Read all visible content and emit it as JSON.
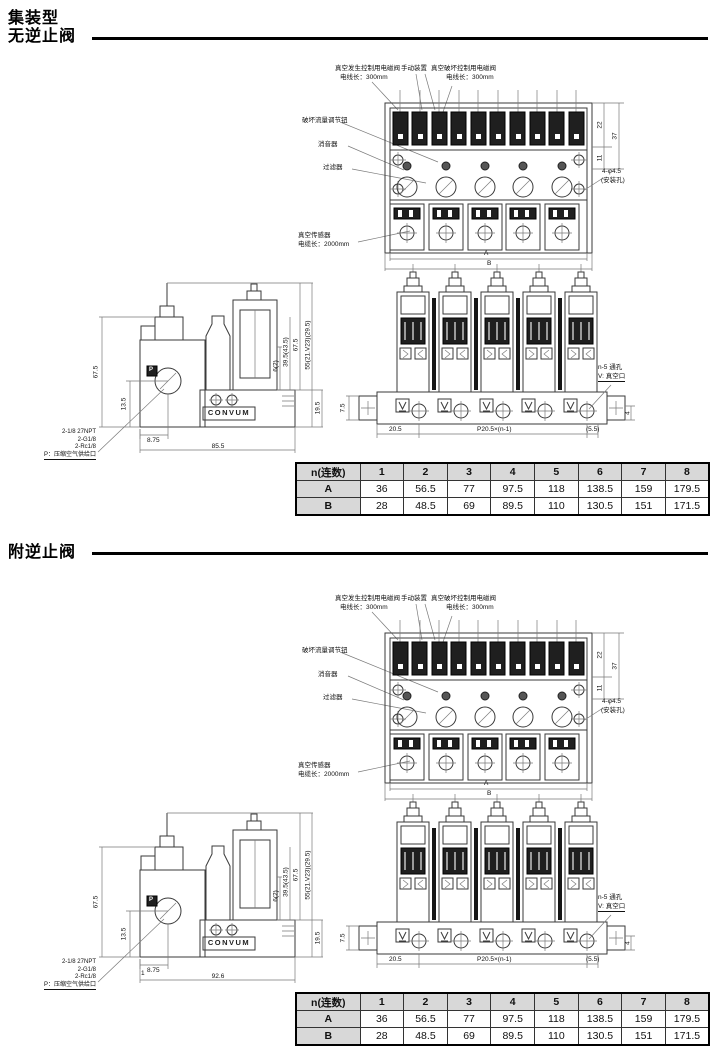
{
  "titles": {
    "group": "集装型",
    "section1": "无逆止阀",
    "section2": "附逆止阀"
  },
  "shared": {
    "front": {
      "solenoid_gen": "真空发生控制用电磁阀",
      "solenoid_gen_wire": "电线长：300mm",
      "manual": "手动装置",
      "solenoid_break": "真空破坏控制用电磁阀",
      "solenoid_break_wire": "电线长：300mm",
      "flow_knob": "破坏流量调节钮",
      "silencer": "消音器",
      "filter": "过滤器",
      "sensor": "真空传感器",
      "sensor_wire": "电缆长：2000mm",
      "dim_a": "A",
      "dim_b": "B",
      "dim22": "22",
      "dim37": "37",
      "dim11": "11",
      "mount_hole": "4-φ4.5",
      "mount_hole_note": "(安装孔)"
    },
    "bottom": {
      "through": "n-5 通孔",
      "vport": "V: 真空口",
      "dim_left": "20.5",
      "dim_pitch": "P20.5×(n-1)",
      "dim_right": "(5.5)",
      "dim_h": "7.5",
      "dim_v": "4"
    },
    "side": {
      "h": "67.5",
      "h_port": "13.5",
      "w_port": "8.75",
      "r1": "6(2)",
      "r2": "39.5(43.5)",
      "r3": "67.5",
      "r4": "55(21.V23)(29.5)",
      "r5": "19.5",
      "port_letter": "P",
      "logo": "CONVUM",
      "port1": "2-1/8 27NPT",
      "port2": "2-G1/8",
      "port3": "2-Rc1/8",
      "port4": "P：压缩空气供给口"
    }
  },
  "section1": {
    "side_width": "85.5",
    "table": {
      "header": [
        "n(连数)",
        "1",
        "2",
        "3",
        "4",
        "5",
        "6",
        "7",
        "8"
      ],
      "row_a": [
        "A",
        "36",
        "56.5",
        "77",
        "97.5",
        "118",
        "138.5",
        "159",
        "179.5"
      ],
      "row_b": [
        "B",
        "28",
        "48.5",
        "69",
        "89.5",
        "110",
        "130.5",
        "151",
        "171.5"
      ]
    }
  },
  "section2": {
    "side_width": "92.6",
    "extra_dim": "1",
    "table": {
      "header": [
        "n(连数)",
        "1",
        "2",
        "3",
        "4",
        "5",
        "6",
        "7",
        "8"
      ],
      "row_a": [
        "A",
        "36",
        "56.5",
        "77",
        "97.5",
        "118",
        "138.5",
        "159",
        "179.5"
      ],
      "row_b": [
        "B",
        "28",
        "48.5",
        "69",
        "89.5",
        "110",
        "130.5",
        "151",
        "171.5"
      ]
    }
  },
  "chart_data": {
    "type": "table",
    "title": "集装型尺寸表 A/B",
    "categories": [
      "1",
      "2",
      "3",
      "4",
      "5",
      "6",
      "7",
      "8"
    ],
    "series": [
      {
        "name": "A",
        "values": [
          36,
          56.5,
          77,
          97.5,
          118,
          138.5,
          159,
          179.5
        ]
      },
      {
        "name": "B",
        "values": [
          28,
          48.5,
          69,
          89.5,
          110,
          130.5,
          151,
          171.5
        ]
      }
    ]
  }
}
